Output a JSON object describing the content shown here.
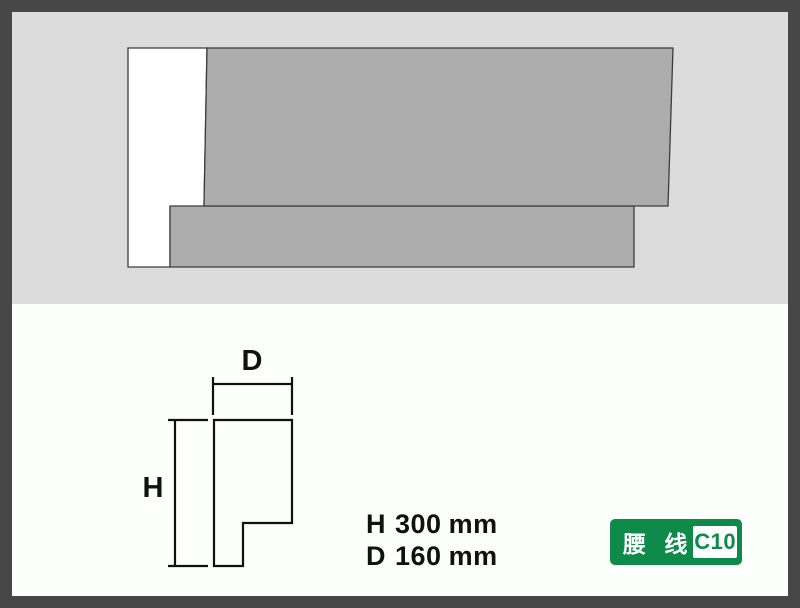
{
  "photo": {
    "shapes": [
      "molding-end-face",
      "molding-top-slab",
      "molding-bottom-slab"
    ]
  },
  "diagram": {
    "depth_label": "D",
    "height_label": "H"
  },
  "specs": {
    "rows": [
      {
        "label": "H",
        "value": "300",
        "unit": "mm"
      },
      {
        "label": "D",
        "value": "160",
        "unit": "mm"
      }
    ]
  },
  "badge": {
    "category": "腰 线",
    "code": "C10"
  },
  "colors": {
    "frame": "#474747",
    "photo_bg": "#dcdcdc",
    "molding_gray": "#adadad",
    "molding_outline": "#3c3c3c",
    "face_white": "#ffffff",
    "drawing_line": "#111111",
    "badge_green": "#0e8a4a",
    "badge_text": "#ffffff"
  }
}
